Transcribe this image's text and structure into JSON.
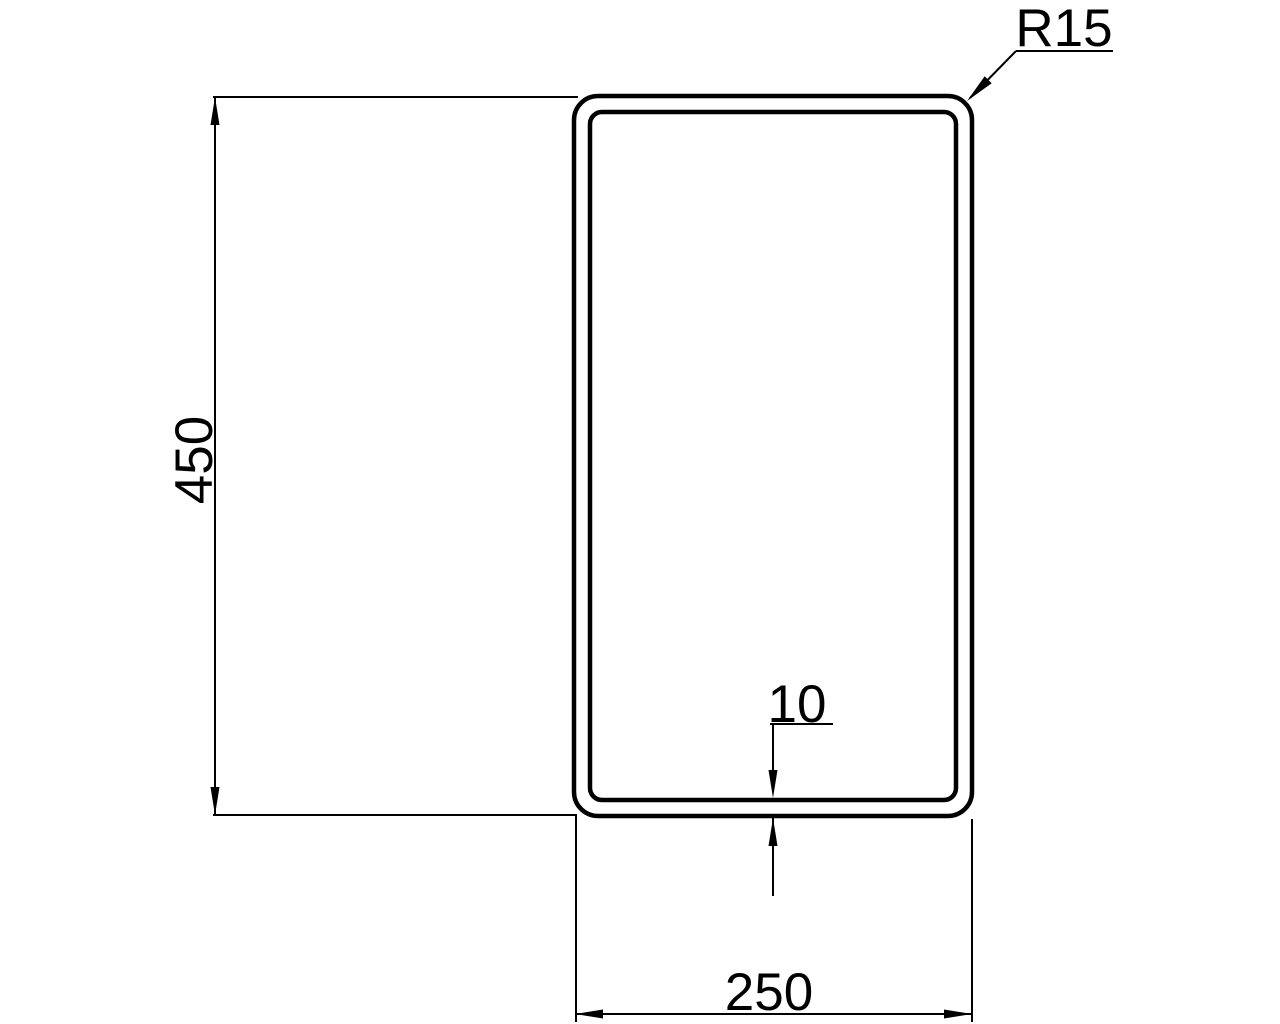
{
  "drawing": {
    "labels": {
      "height_dim": "450",
      "width_dim": "250",
      "thickness_dim": "10",
      "radius_dim": "R15"
    },
    "colors": {
      "line": "#000000",
      "background": "#ffffff"
    }
  }
}
